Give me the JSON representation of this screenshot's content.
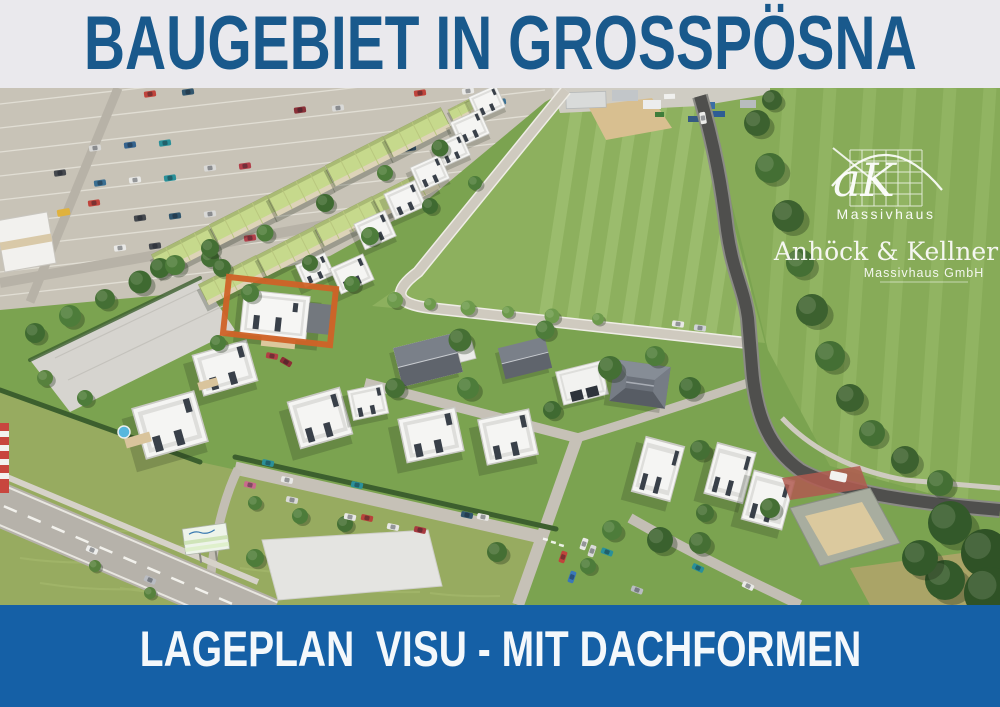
{
  "header": {
    "title": "BAUGEBIET IN GROSSPÖSNA"
  },
  "footer": {
    "caption": "LAGEPLAN  VISU - MIT DACHFORMEN"
  },
  "logo": {
    "initials": "aK",
    "brand": "Massivhaus",
    "company": "Anhöck & Kellner",
    "company_sub": "Massivhaus GmbH"
  },
  "colors": {
    "header_bg": "#eae9ed",
    "title_text": "#19598c",
    "footer_bg": "#1560a6",
    "footer_text": "#f4f8fb",
    "highlight": "#d06227"
  }
}
